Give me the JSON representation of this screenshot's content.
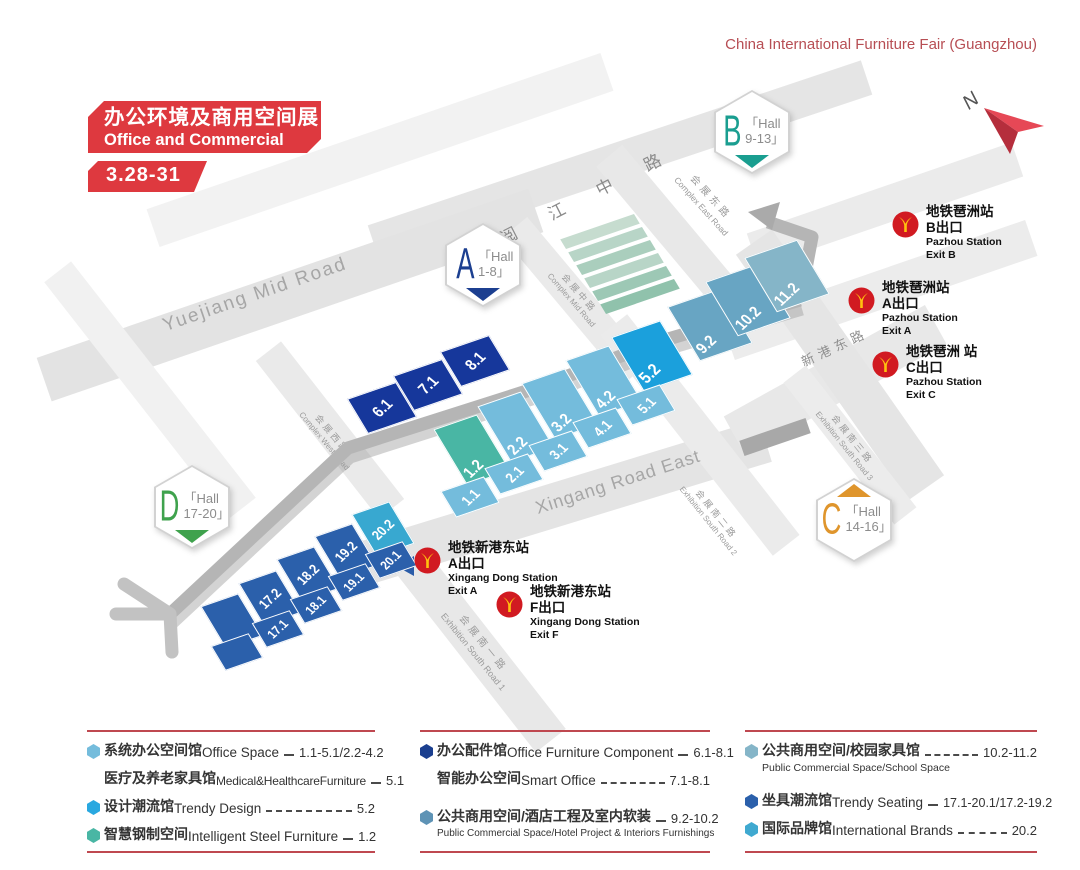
{
  "fair_title": "China International Furniture Fair (Guangzhou)",
  "banner": {
    "title_zh": "办公环境及商用空间展",
    "title_en": "Office and Commercial Space",
    "dates": "3.28-31"
  },
  "north": {
    "label": "N"
  },
  "colors": {
    "banner_red": "#de393f",
    "accent_red": "#b74e54",
    "rule_red": "#bf4850",
    "metro_red": "#d11a21",
    "metro_yellow": "#ffc10e",
    "office_space": "#74bcdc",
    "trendy_design": "#1ba0dc",
    "intelligent_steel": "#49b6a4",
    "office_component": "#16379b",
    "public_hotel": "#68a5c3",
    "school_space": "#85b5c8",
    "trendy_seating": "#2b60ab",
    "international_brands": "#38a8d0",
    "badge_a": "#1c3f90",
    "badge_b": "#1a9e90",
    "badge_c": "#df952c",
    "badge_d": "#3fa24d"
  },
  "badges": [
    {
      "letter": "A",
      "hall_line1": "「Hall",
      "hall_line2": "1-8」",
      "color": "#1c3f90"
    },
    {
      "letter": "B",
      "hall_line1": "「Hall",
      "hall_line2": "9-13」",
      "color": "#1a9e90"
    },
    {
      "letter": "C",
      "hall_line1": "「Hall",
      "hall_line2": "14-16」",
      "color": "#df952c"
    },
    {
      "letter": "D",
      "hall_line1": "「Hall",
      "hall_line2": "17-20」",
      "color": "#3fa24d"
    }
  ],
  "roads": {
    "yuejiang_zh": "阅 江 中 路",
    "yuejiang_en": "Yuejiang Mid Road",
    "xingang_en": "Xingang Road East",
    "xingang_zh": "新港东路",
    "complex_west_zh": "会展西路",
    "complex_west_en": "Complex West Road",
    "complex_mid_zh": "会展中路",
    "complex_mid_en": "Complex Mid Road",
    "complex_east_zh": "会展东路",
    "complex_east_en": "Complex East Road",
    "south1_zh": "会展南一路",
    "south1_en": "Exhibition South Road 1",
    "south2_zh": "会展南二路",
    "south2_en": "Exhibition South Road 2",
    "south3_zh": "会展南三路",
    "south3_en": "Exhibition South Road 3"
  },
  "stations": [
    {
      "zh_line1": "地铁琶洲站",
      "zh_line2": "B出口",
      "en_line1": "Pazhou Station",
      "en_line2": "Exit B"
    },
    {
      "zh_line1": "地铁琶洲站",
      "zh_line2": "A出口",
      "en_line1": "Pazhou Station",
      "en_line2": "Exit A"
    },
    {
      "zh_line1": "地铁琶洲 站",
      "zh_line2": "C出口",
      "en_line1": "Pazhou Station",
      "en_line2": "Exit C"
    },
    {
      "zh_line1": "地铁新港东站",
      "zh_line2": "A出口",
      "en_line1": "Xingang Dong Station",
      "en_line2": "Exit A"
    },
    {
      "zh_line1": "地铁新港东站",
      "zh_line2": "F出口",
      "en_line1": "Xingang Dong Station",
      "en_line2": "Exit F"
    }
  ],
  "blocks": [
    {
      "label": "6.1"
    },
    {
      "label": "7.1"
    },
    {
      "label": "8.1"
    },
    {
      "label": "1.2"
    },
    {
      "label": "2.2"
    },
    {
      "label": "3.2"
    },
    {
      "label": "4.2"
    },
    {
      "label": "5.2"
    },
    {
      "label": "1.1"
    },
    {
      "label": "2.1"
    },
    {
      "label": "3.1"
    },
    {
      "label": "4.1"
    },
    {
      "label": "5.1"
    },
    {
      "label": "9.2"
    },
    {
      "label": "10.2"
    },
    {
      "label": "11.2"
    },
    {
      "label": "17.2"
    },
    {
      "label": "18.2"
    },
    {
      "label": "19.2"
    },
    {
      "label": "20.2"
    },
    {
      "label": "17.1"
    },
    {
      "label": "18.1"
    },
    {
      "label": "19.1"
    },
    {
      "label": "20.1"
    }
  ],
  "legend": {
    "col1": {
      "r1": {
        "zh": "系统办公空间馆",
        "en": "Office Space",
        "value": "1.1-5.1/2.2-4.2",
        "color": "#74bcdc"
      },
      "r2": {
        "zh": "医疗及养老家具馆",
        "en": "Medical&HealthcareFurniture",
        "value": "5.1"
      },
      "r3": {
        "zh": "设计潮流馆",
        "en": "Trendy Design",
        "value": "5.2",
        "color": "#29a8e0"
      },
      "r4": {
        "zh": "智慧钢制空间",
        "en": "Intelligent Steel Furniture",
        "value": "1.2",
        "color": "#49b6a4"
      }
    },
    "col2": {
      "r1": {
        "zh": "办公配件馆",
        "en": "Office Furniture Component",
        "value": "6.1-8.1",
        "color": "#1b3f8f"
      },
      "r2": {
        "zh": "智能办公空间",
        "en": "Smart Office",
        "value": "7.1-8.1"
      },
      "r3": {
        "zh": "公共商用空间/酒店工程及室内软装",
        "value": "9.2-10.2",
        "color": "#5e93b5",
        "subtitle": "Public Commercial Space/Hotel Project & Interiors Furnishings"
      }
    },
    "col3": {
      "r1": {
        "zh": "公共商用空间/校园家具馆",
        "value": "10.2-11.2",
        "color": "#85b5c8",
        "subtitle": "Public Commercial Space/School Space"
      },
      "r2": {
        "zh": "坐具潮流馆",
        "en": "Trendy Seating",
        "value": "17.1-20.1/17.2-19.2",
        "color": "#2b60ab"
      },
      "r3": {
        "zh": "国际品牌馆",
        "en": "International Brands",
        "value": "20.2",
        "color": "#3fa9d0"
      }
    }
  }
}
